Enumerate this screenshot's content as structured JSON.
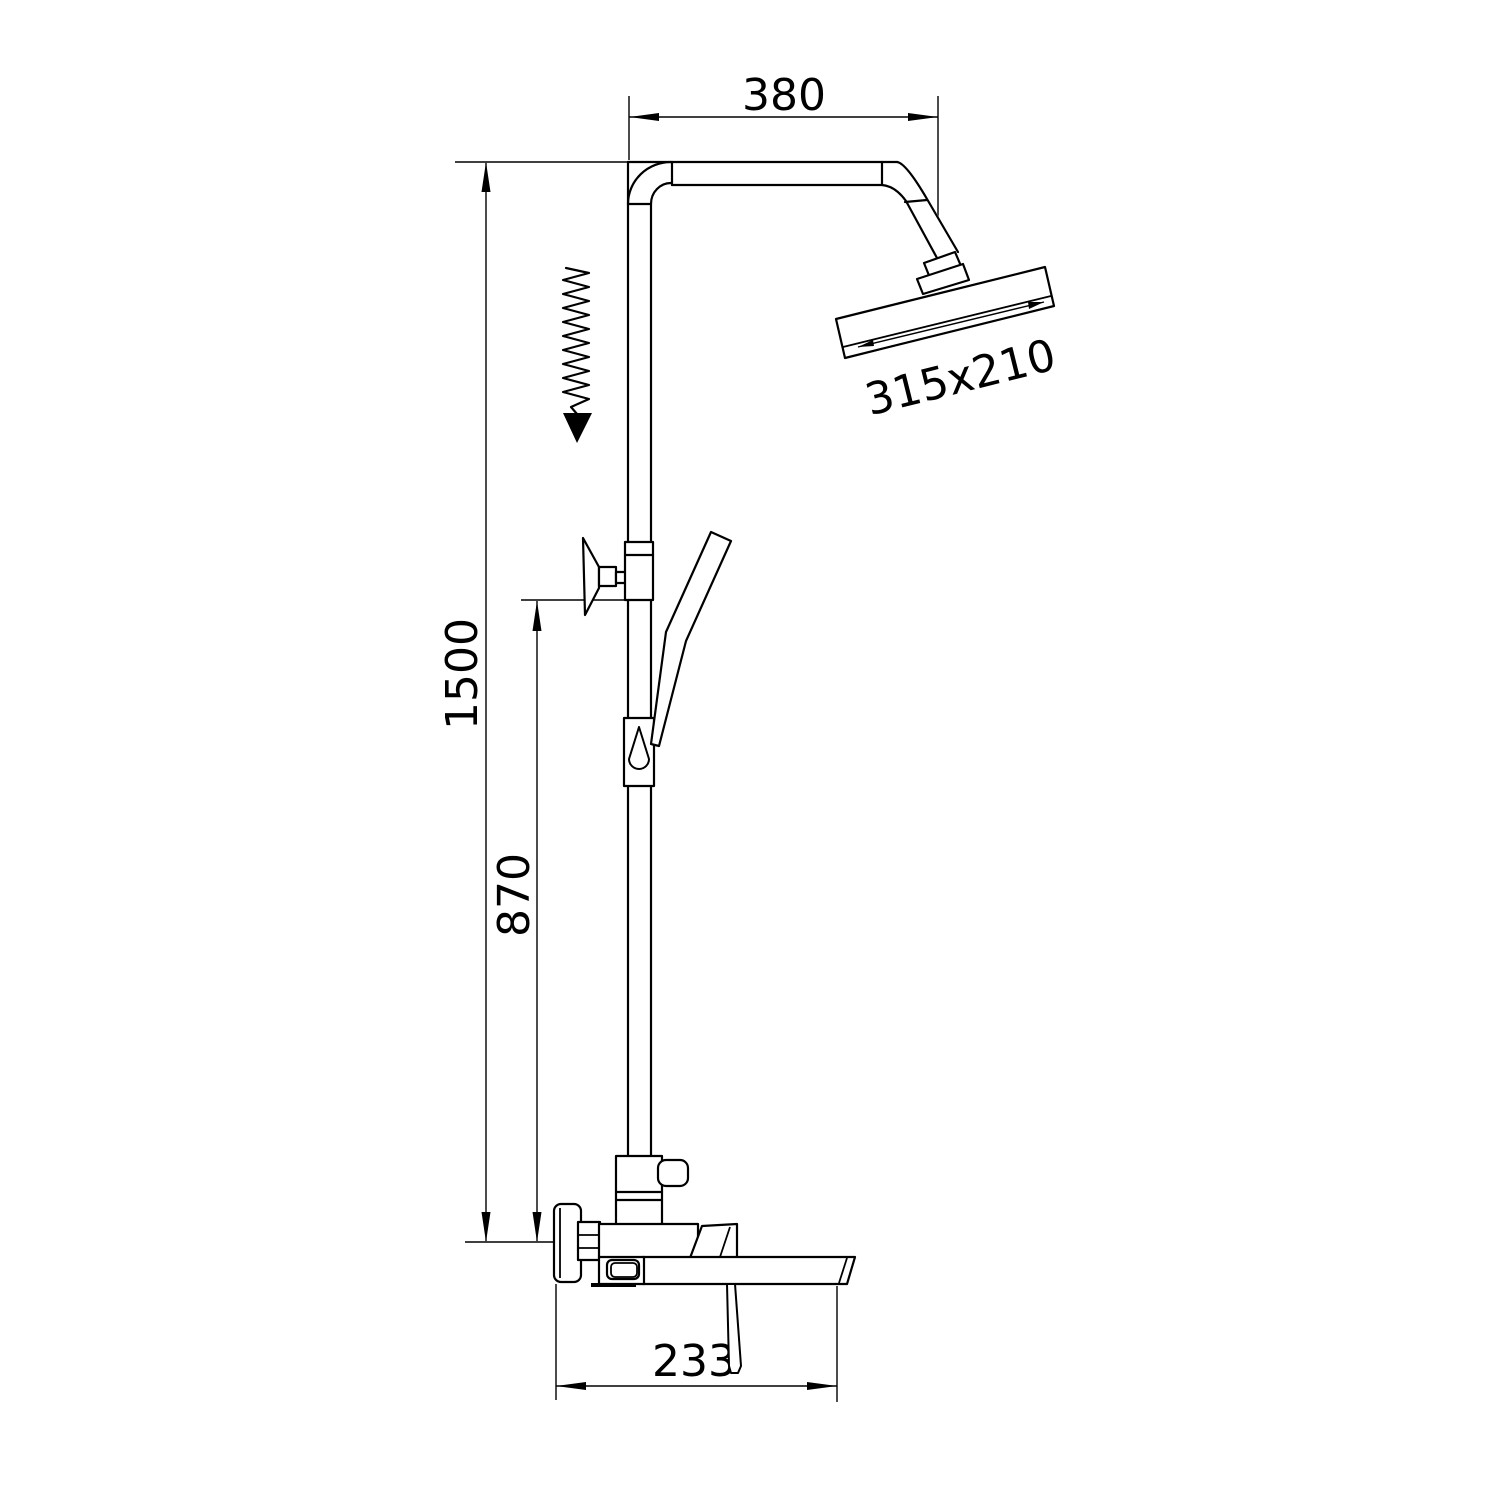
{
  "drawing": {
    "type": "technical line drawing - wall mounted shower column with rain head, hand shower and tub spout mixer, side elevation",
    "background": "#ffffff",
    "line_color": "#000000",
    "dimensions": {
      "arm_width": "380",
      "head_size": "315x210",
      "total_height": "1500",
      "mixer_height": "870",
      "spout_reach": "233"
    },
    "symbols": {
      "height_adjust": "spring-zigzag-with-down-arrow"
    }
  }
}
